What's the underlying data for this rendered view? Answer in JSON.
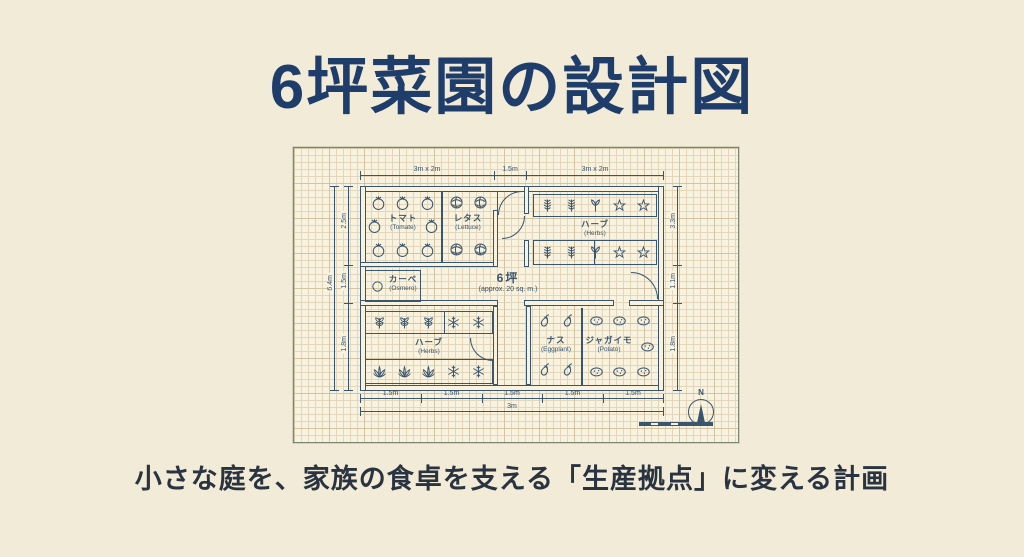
{
  "title": "6坪菜園の設計図",
  "caption": "小さな庭を、家族の食卓を支える「生産拠点」に変える計画",
  "colors": {
    "bg": "#f1ebd8",
    "paper": "#f8f2df",
    "grid": "#e2d7bc",
    "ink": "#3a556e",
    "title": "#1e3d6b",
    "caption": "#2a3340"
  },
  "plan": {
    "area_label": "6坪",
    "area_sublabel": "(approx. 20 sq. m.)",
    "compass_label": "N",
    "rooms": {
      "tomato": {
        "label": "トマト",
        "sublabel": "(Tomate)"
      },
      "lettuce": {
        "label": "レタス",
        "sublabel": "(Lettuce)"
      },
      "herbs_top": {
        "label": "ハーブ",
        "sublabel": "(Herbs)"
      },
      "storage": {
        "label": "カーベ",
        "sublabel": "(Osmero)"
      },
      "herbs_bottom": {
        "label": "ハーブ",
        "sublabel": "(Herbs)"
      },
      "eggplant": {
        "label": "ナス",
        "sublabel": "(Eggplant)"
      },
      "potato": {
        "label": "ジャガイモ",
        "sublabel": "(Potato)"
      }
    },
    "dimensions": {
      "top": [
        "3m x 2m",
        "1.5m",
        "3m x 2m"
      ],
      "left_outer": "6.4m",
      "left_inner": [
        "2.5m",
        "1.5m",
        "1.8m"
      ],
      "right": [
        "3.3m",
        "1.1m",
        "1.8m"
      ],
      "bottom": [
        "1.5m",
        "1.5m",
        "1.5m",
        "1.5m",
        "1.5m"
      ],
      "bottom_total": "3m"
    },
    "icons": {
      "tomato_r1": [
        "tomato",
        "tomato",
        "tomato"
      ],
      "tomato_r2": [
        "tomato",
        "tomato"
      ],
      "tomato_r3": [
        "tomato",
        "tomato",
        "tomato"
      ],
      "lettuce_r1": [
        "lettuce",
        "lettuce"
      ],
      "lettuce_r3": [
        "lettuce",
        "lettuce"
      ],
      "herbs_top_r1": [
        "fern",
        "fern",
        "holly",
        "star",
        "star"
      ],
      "herbs_top_r2": [
        "fern",
        "fern",
        "holly",
        "star",
        "star"
      ],
      "herbs_bottom_r1": [
        "basil",
        "basil",
        "basil",
        "snow",
        "snow"
      ],
      "herbs_bottom_r2": [
        "lotus",
        "lotus",
        "lotus",
        "snow",
        "snow"
      ],
      "eggplant_r1": [
        "eggplant",
        "eggplant"
      ],
      "eggplant_r2": [
        "eggplant",
        "eggplant"
      ],
      "potato_r1": [
        "potato",
        "potato",
        "potato"
      ],
      "potato_mid": [
        "potato"
      ],
      "potato_r2": [
        "potato",
        "potato",
        "potato"
      ],
      "storage_icon": [
        "circle"
      ]
    }
  }
}
